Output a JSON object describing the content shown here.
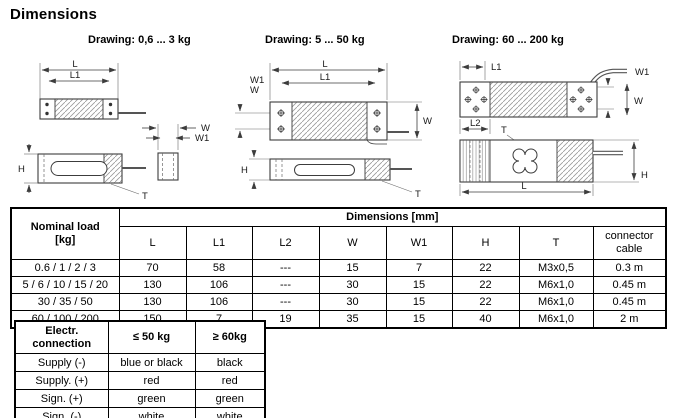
{
  "title": "Dimensions",
  "drawing_labels": [
    "Drawing: 0,6 ... 3 kg",
    "Drawing: 5 ... 50 kg",
    "Drawing: 60 ... 200 kg"
  ],
  "dim_labels": {
    "L": "L",
    "L1": "L1",
    "L2": "L2",
    "W": "W",
    "W1": "W1",
    "H": "H",
    "T": "T"
  },
  "main_table": {
    "nominal_load_header": "Nominal load",
    "nominal_load_unit": "[kg]",
    "dimensions_header": "Dimensions [mm]",
    "column_headers": [
      "L",
      "L1",
      "L2",
      "W",
      "W1",
      "H",
      "T"
    ],
    "connector_header_line1": "connector",
    "connector_header_line2": "cable",
    "rows": [
      {
        "load": "0.6 / 1 / 2 / 3",
        "l": "70",
        "l1": "58",
        "l2": "---",
        "w": "15",
        "w1": "7",
        "h": "22",
        "t": "M3x0,5",
        "cable": "0.3 m"
      },
      {
        "load": "5 / 6 / 10 / 15 / 20",
        "l": "130",
        "l1": "106",
        "l2": "---",
        "w": "30",
        "w1": "15",
        "h": "22",
        "t": "M6x1,0",
        "cable": "0.45 m"
      },
      {
        "load": "30 / 35 / 50",
        "l": "130",
        "l1": "106",
        "l2": "---",
        "w": "30",
        "w1": "15",
        "h": "22",
        "t": "M6x1,0",
        "cable": "0.45 m"
      },
      {
        "load": "60 / 100 / 200",
        "l": "150",
        "l1": "7",
        "l2": "19",
        "w": "35",
        "w1": "15",
        "h": "40",
        "t": "M6x1,0",
        "cable": "2 m"
      }
    ]
  },
  "electrical_table": {
    "header_line1": "Electr.",
    "header_line2": "connection",
    "col_le50": "≤ 50 kg",
    "col_ge60": "≥ 60kg",
    "rows": [
      {
        "label": "Supply (-)",
        "le50": "blue or black",
        "ge60": "black"
      },
      {
        "label": "Supply. (+)",
        "le50": "red",
        "ge60": "red"
      },
      {
        "label": "Sign. (+)",
        "le50": "green",
        "ge60": "green"
      },
      {
        "label": "Sign. (-)",
        "le50": "white",
        "ge60": "white"
      }
    ]
  },
  "colors": {
    "line": "#3c3c3c",
    "hatch": "#999999",
    "border": "#000000",
    "background": "#ffffff"
  }
}
